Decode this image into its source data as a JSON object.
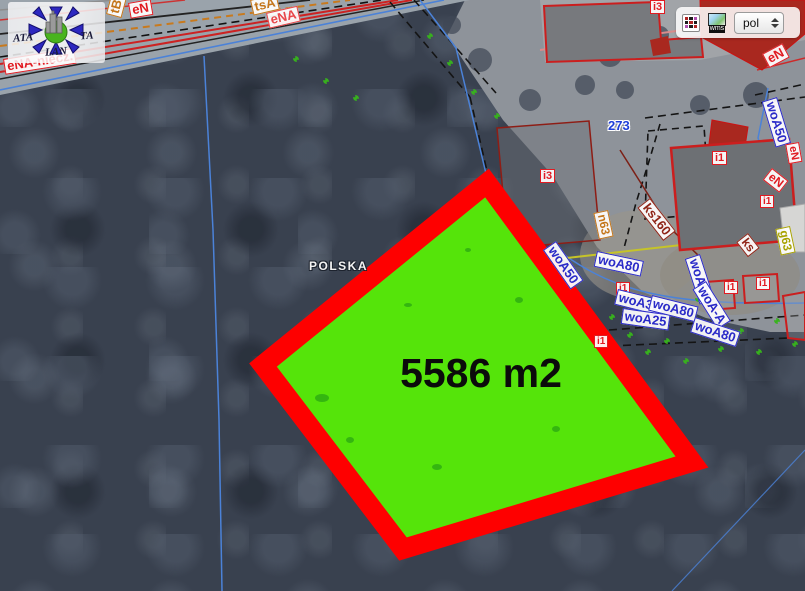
{
  "watermark": {
    "left": "ATA",
    "right": "TA",
    "bottom": "LAN"
  },
  "toolbar": {
    "wms_label": "wms",
    "language_value": "pol"
  },
  "parcel": {
    "area_label": "5586 m2"
  },
  "colors": {
    "parcel_fill": "#55e40a",
    "parcel_border": "#fe0000",
    "label_red": "#e11b22",
    "label_blue": "#2a2ac8",
    "label_orange": "#c4761b",
    "label_darkred": "#8f2417",
    "label_olive": "#a8a200"
  },
  "map": {
    "country_label": "POLSKA",
    "labels": [
      {
        "text": "tB",
        "x": 106,
        "y": 14,
        "rot": -75,
        "color": "#c4761b",
        "size": 13,
        "boxed": true
      },
      {
        "text": "eN",
        "x": 128,
        "y": 3,
        "rot": -10,
        "color": "#e11b22",
        "size": 13,
        "boxed": true
      },
      {
        "text": "tsA",
        "x": 250,
        "y": 0,
        "rot": -13,
        "color": "#c4761b",
        "size": 13,
        "boxed": true
      },
      {
        "text": "eNA",
        "x": 266,
        "y": 13,
        "rot": -13,
        "color": "#e8474b",
        "size": 13,
        "boxed": true
      },
      {
        "text": "eNA-niecz.",
        "x": 3,
        "y": 59,
        "rot": -9,
        "color": "#e11b22",
        "size": 13,
        "boxed": true
      },
      {
        "text": "i3",
        "x": 650,
        "y": 0,
        "rot": 0,
        "color": "#e11b22",
        "size": 11,
        "boxed": true
      },
      {
        "text": "eN",
        "x": 762,
        "y": 54,
        "rot": -28,
        "color": "#e11b22",
        "size": 13,
        "boxed": true
      },
      {
        "text": "woA50",
        "x": 777,
        "y": 97,
        "rot": 73,
        "color": "#2a2ac8",
        "size": 13,
        "boxed": true
      },
      {
        "text": "eN",
        "x": 799,
        "y": 142,
        "rot": 80,
        "color": "#e11b22",
        "size": 11,
        "boxed": true
      },
      {
        "text": "eN",
        "x": 772,
        "y": 168,
        "rot": 38,
        "color": "#e11b22",
        "size": 12,
        "boxed": true
      },
      {
        "text": "273",
        "x": 608,
        "y": 119,
        "rot": 0,
        "color": "#1f3fd8",
        "size": 13,
        "boxed": false,
        "halo": "halo"
      },
      {
        "text": "i3",
        "x": 540,
        "y": 169,
        "rot": 0,
        "color": "#e11b22",
        "size": 11,
        "boxed": true
      },
      {
        "text": "n63",
        "x": 608,
        "y": 210,
        "rot": 78,
        "color": "#c4761b",
        "size": 12,
        "boxed": true
      },
      {
        "text": "ks160",
        "x": 650,
        "y": 198,
        "rot": 52,
        "color": "#8f2417",
        "size": 13,
        "boxed": true
      },
      {
        "text": "i1",
        "x": 712,
        "y": 151,
        "rot": 0,
        "color": "#e11b22",
        "size": 11,
        "boxed": true
      },
      {
        "text": "i1",
        "x": 760,
        "y": 195,
        "rot": 0,
        "color": "#e11b22",
        "size": 10,
        "boxed": true
      },
      {
        "text": "ks",
        "x": 748,
        "y": 233,
        "rot": 52,
        "color": "#8f2417",
        "size": 12,
        "boxed": true
      },
      {
        "text": "g63",
        "x": 790,
        "y": 226,
        "rot": 78,
        "color": "#a8a200",
        "size": 12,
        "boxed": true
      },
      {
        "text": "woA50",
        "x": 556,
        "y": 241,
        "rot": 55,
        "color": "#2a2ac8",
        "size": 13,
        "boxed": true
      },
      {
        "text": "woA80",
        "x": 597,
        "y": 251,
        "rot": 12,
        "color": "#2a2ac8",
        "size": 13,
        "boxed": true
      },
      {
        "text": "i1",
        "x": 616,
        "y": 282,
        "rot": 0,
        "color": "#e11b22",
        "size": 10,
        "boxed": true
      },
      {
        "text": "woA32",
        "x": 618,
        "y": 289,
        "rot": 14,
        "color": "#2a2ac8",
        "size": 13,
        "boxed": true
      },
      {
        "text": "woA25",
        "x": 623,
        "y": 308,
        "rot": 8,
        "color": "#2a2ac8",
        "size": 13,
        "boxed": true
      },
      {
        "text": "woA90",
        "x": 700,
        "y": 254,
        "rot": 72,
        "color": "#2a2ac8",
        "size": 13,
        "boxed": true
      },
      {
        "text": "woA-A",
        "x": 706,
        "y": 281,
        "rot": 58,
        "color": "#2a2ac8",
        "size": 13,
        "boxed": true
      },
      {
        "text": "woA80",
        "x": 652,
        "y": 295,
        "rot": 14,
        "color": "#2a2ac8",
        "size": 13,
        "boxed": true
      },
      {
        "text": "woA80",
        "x": 695,
        "y": 317,
        "rot": 18,
        "color": "#2a2ac8",
        "size": 13,
        "boxed": true
      },
      {
        "text": "i1",
        "x": 724,
        "y": 281,
        "rot": 0,
        "color": "#e11b22",
        "size": 10,
        "boxed": true
      },
      {
        "text": "i1",
        "x": 756,
        "y": 277,
        "rot": 0,
        "color": "#e11b22",
        "size": 10,
        "boxed": true
      },
      {
        "text": "i1",
        "x": 594,
        "y": 335,
        "rot": 0,
        "color": "#e11b22",
        "size": 10,
        "boxed": true
      },
      {
        "text": "POLSKA",
        "x": 309,
        "y": 260,
        "rot": 0,
        "color": "#f2f2f2",
        "size": 12,
        "boxed": false,
        "halo": "halo-dark"
      }
    ],
    "vegetation_marks": [
      [
        296,
        59
      ],
      [
        326,
        81
      ],
      [
        356,
        98
      ],
      [
        430,
        36
      ],
      [
        450,
        63
      ],
      [
        474,
        92
      ],
      [
        497,
        116
      ],
      [
        612,
        317
      ],
      [
        630,
        335
      ],
      [
        648,
        352
      ],
      [
        667,
        341
      ],
      [
        686,
        361
      ],
      [
        703,
        329
      ],
      [
        721,
        349
      ],
      [
        741,
        331
      ],
      [
        759,
        352
      ],
      [
        777,
        321
      ],
      [
        795,
        344
      ],
      [
        698,
        299
      ],
      [
        672,
        305
      ]
    ],
    "parcel_patches": [
      [
        322,
        398,
        7,
        4
      ],
      [
        437,
        467,
        5,
        3
      ],
      [
        519,
        300,
        4,
        3
      ],
      [
        556,
        429,
        4,
        3
      ],
      [
        468,
        250,
        3,
        2
      ],
      [
        408,
        305,
        4,
        2
      ],
      [
        350,
        440,
        4,
        3
      ]
    ]
  }
}
